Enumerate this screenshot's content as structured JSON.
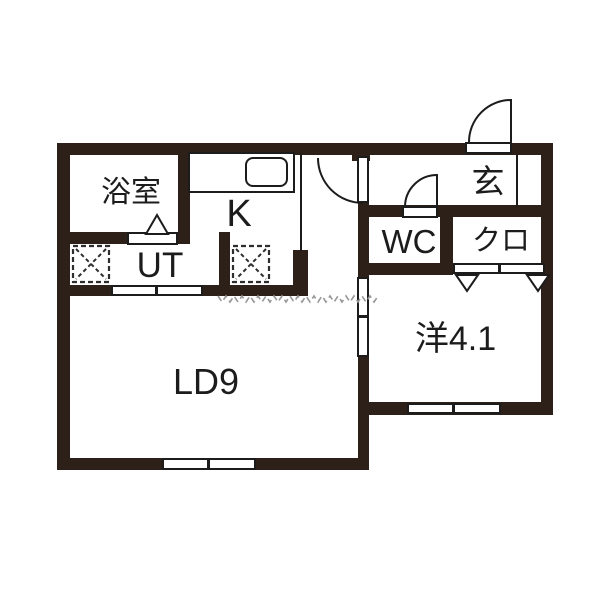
{
  "colors": {
    "wall": "#2d2019",
    "line": "#1c1c1c",
    "text": "#1c1c1c",
    "hatch": "#979797",
    "bg": "#ffffff"
  },
  "rooms": {
    "bathroom": {
      "label": "浴室"
    },
    "kitchen": {
      "label": "K"
    },
    "entrance": {
      "label": "玄"
    },
    "wc": {
      "label": "WC"
    },
    "closet": {
      "label": "クロ"
    },
    "utility": {
      "label": "UT"
    },
    "western_room": {
      "label": "洋4.1"
    },
    "living_dining": {
      "label": "LD9"
    }
  },
  "symbols": {
    "entrance_swing_door": "quarter-arc-door",
    "hall_swing_door": "quarter-arc-door",
    "wc_swing_door": "quarter-arc-door",
    "bathroom_folding_door": "triangle-door",
    "closet_folding_doors": "double-triangle-door",
    "washer_space": "dashed-x-square",
    "fridge_space": "dashed-x-square",
    "kitchen_sink": "rounded-rect-sink",
    "west_room_sliding_door": "white-panel-pair",
    "utility_sliding_door": "white-panel-pair",
    "ld_window": "white-panel-pair",
    "west_window": "white-panel-pair",
    "hall_boundary_hatch": "zigzag-marks"
  }
}
